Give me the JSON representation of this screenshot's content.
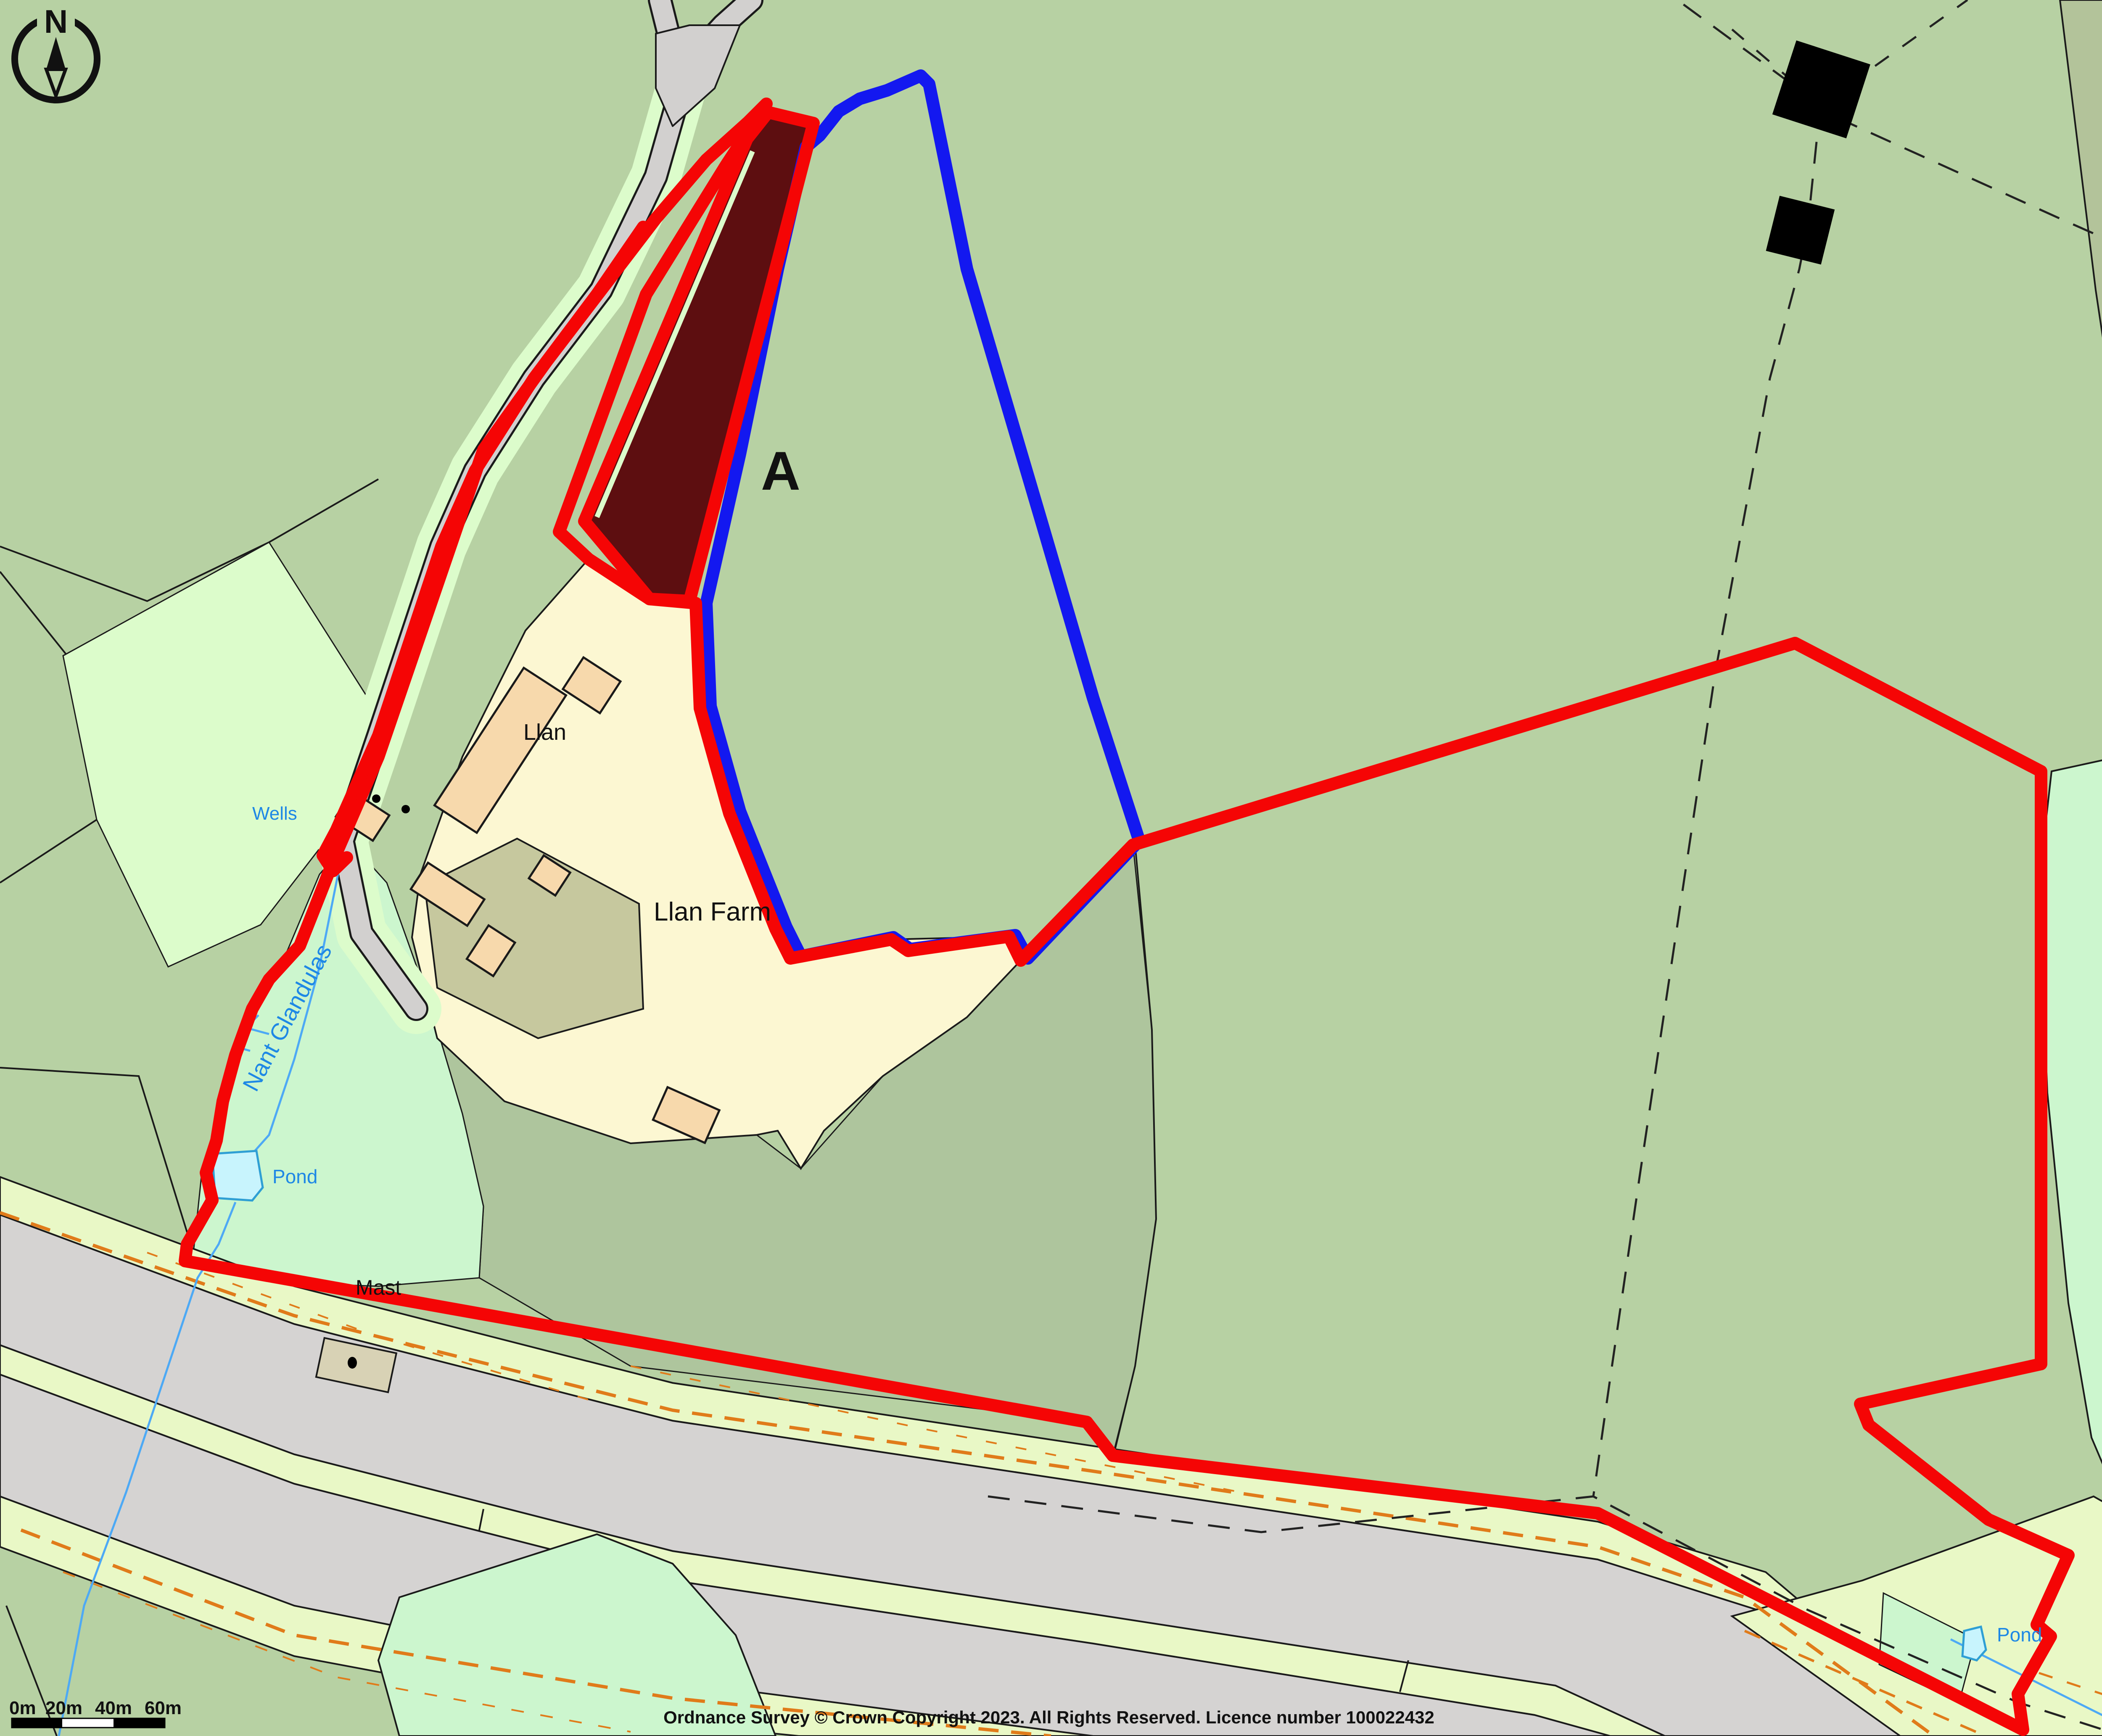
{
  "map": {
    "compass_n": "N",
    "parcel_label": "A",
    "labels": {
      "llan": "Llan",
      "llan_farm": "Llan Farm",
      "wells": "Wells",
      "stream_name": "Nant Glandulas",
      "pond_west": "Pond",
      "pond_southeast": "Pond",
      "mast": "Mast",
      "spring": "Spring",
      "drain": "Drain"
    },
    "colors": {
      "boundary_red": "#f50505",
      "boundary_blue": "#1318f0",
      "parcel_a_fill": "#5d0e10",
      "field_green": "#b7d1a3",
      "field_dark_green": "#aec59d",
      "rough_olive": "#b3c39a",
      "rough_mint": "#ccf6ce",
      "verge_pale": "#e9f8c6",
      "road_gray": "#d5d3d2",
      "farm_cream": "#fcf7d2",
      "building_peach": "#f7d9ac",
      "yard_olive": "#c6c89e",
      "water_fill": "#c8f4fd",
      "water_line": "#4da9f5",
      "route_orange": "#e07b1a"
    }
  },
  "scale_bar": {
    "t0": "0m",
    "t20": "20m",
    "t40": "40m",
    "t60": "60m"
  },
  "attribution": "Ordnance Survey © Crown Copyright 2023. All Rights Reserved. Licence number 100022432",
  "branding": {
    "name": "Promap",
    "subtitle": "LANDMARK INFORMATION"
  }
}
